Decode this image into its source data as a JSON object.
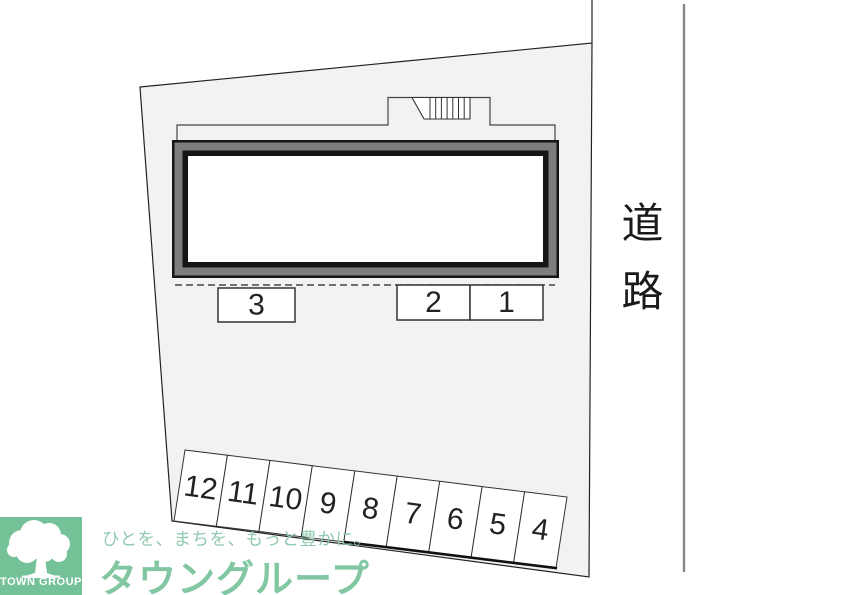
{
  "plan": {
    "road": {
      "label": "道路"
    },
    "parking": {
      "upper_row": {
        "spaces": [
          "3",
          "2",
          "1"
        ]
      },
      "lower_row": {
        "spaces": [
          "12",
          "11",
          "10",
          "9",
          "8",
          "7",
          "6",
          "5",
          "4"
        ]
      }
    }
  },
  "logo": {
    "badge_text": "TOWN GROUP",
    "tagline": "ひとを、まちを、もっと豊かに。",
    "company": "タウングループ"
  },
  "colors": {
    "site_fill": "#f2f2f2",
    "building_band_gray": "#7d7d7d",
    "line_black": "#1a1a1a",
    "road_line_gray": "#878787",
    "brand_green": "#75c198",
    "brand_green_light": "#8cc8ab"
  }
}
